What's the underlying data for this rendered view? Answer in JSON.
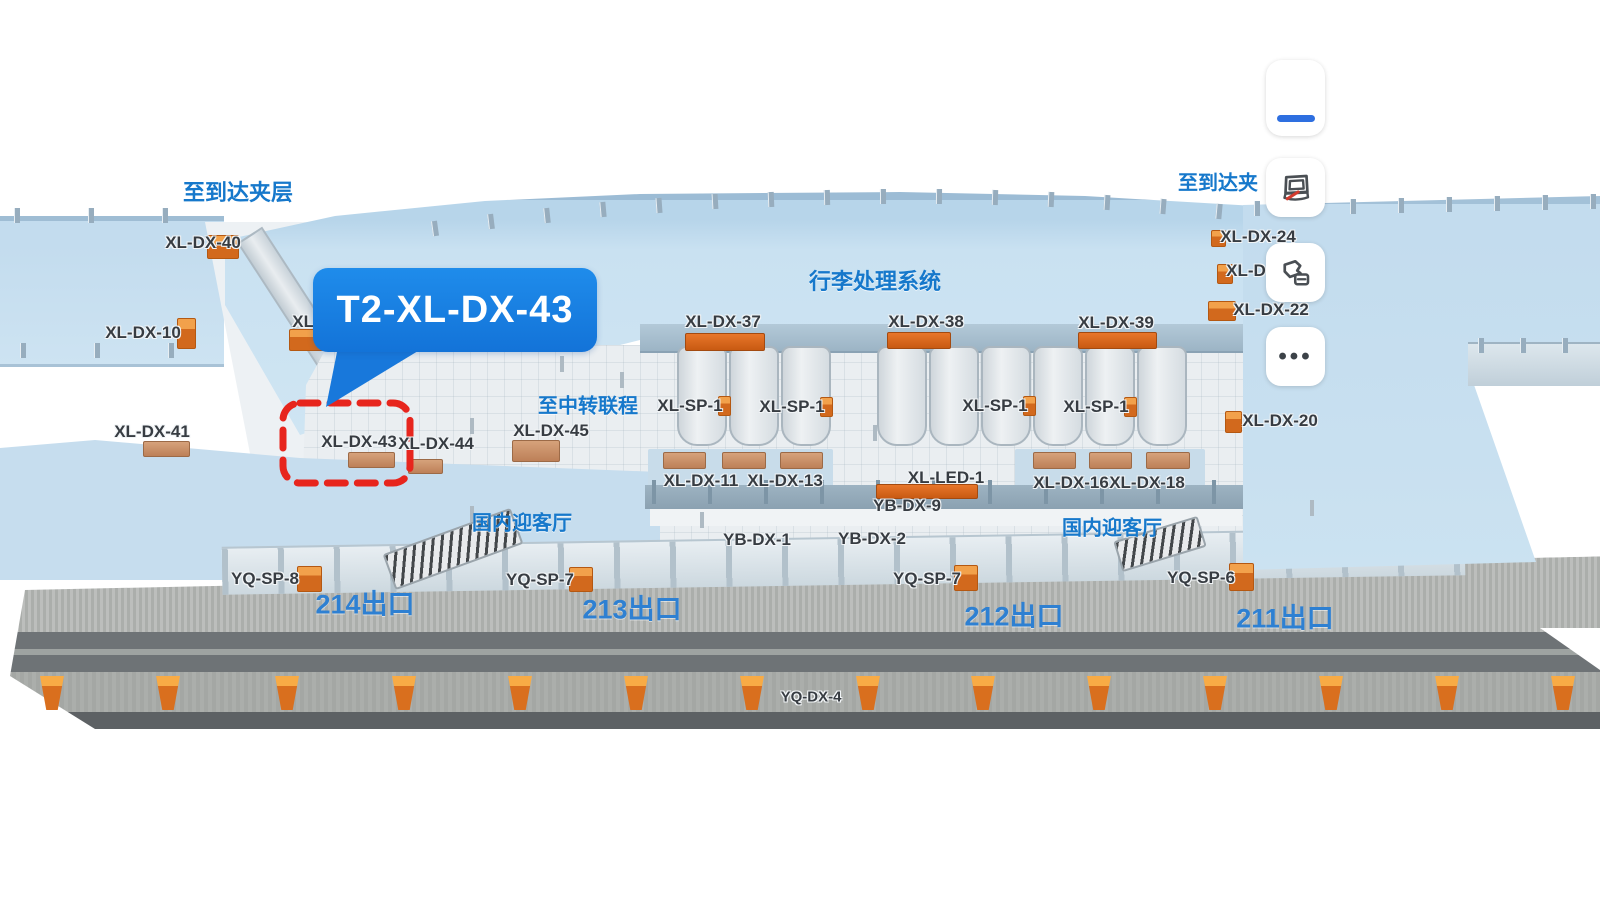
{
  "callout": {
    "label": "T2-XL-DX-43"
  },
  "zones": [
    {
      "text": "至到达夹层",
      "x": 238,
      "y": 191,
      "fs": 22
    },
    {
      "text": "行李处理系统",
      "x": 875,
      "y": 280,
      "fs": 22
    },
    {
      "text": "至中转联程",
      "x": 588,
      "y": 404,
      "fs": 20
    },
    {
      "text": "国内迎客厅",
      "x": 522,
      "y": 521,
      "fs": 20
    },
    {
      "text": "国内迎客厅",
      "x": 1112,
      "y": 526,
      "fs": 20
    },
    {
      "text": "至到达夹",
      "x": 1218,
      "y": 181,
      "fs": 20
    }
  ],
  "exits": [
    {
      "text": "214出口",
      "x": 365,
      "y": 602
    },
    {
      "text": "213出口",
      "x": 632,
      "y": 607
    },
    {
      "text": "212出口",
      "x": 1014,
      "y": 614
    },
    {
      "text": "211出口",
      "x": 1285,
      "y": 616
    }
  ],
  "devices": [
    {
      "text": "XL-DX-40",
      "x": 203,
      "y": 243
    },
    {
      "text": "XL-DX-10",
      "x": 143,
      "y": 333
    },
    {
      "text": "XL-DX-41",
      "x": 152,
      "y": 432
    },
    {
      "text": "XL-",
      "x": 306,
      "y": 322
    },
    {
      "text": "XL-DX-43",
      "x": 359,
      "y": 442
    },
    {
      "text": "XL-DX-44",
      "x": 436,
      "y": 444
    },
    {
      "text": "XL-DX-45",
      "x": 551,
      "y": 431
    },
    {
      "text": "XL-DX-37",
      "x": 723,
      "y": 322
    },
    {
      "text": "XL-DX-38",
      "x": 926,
      "y": 322
    },
    {
      "text": "XL-DX-39",
      "x": 1116,
      "y": 323
    },
    {
      "text": "XL-SP-1",
      "x": 690,
      "y": 406
    },
    {
      "text": "XL-SP-1",
      "x": 792,
      "y": 407
    },
    {
      "text": "XL-SP-1",
      "x": 995,
      "y": 406
    },
    {
      "text": "XL-SP-1",
      "x": 1096,
      "y": 407
    },
    {
      "text": "XL-DX-11",
      "x": 701,
      "y": 481
    },
    {
      "text": "XL-DX-13",
      "x": 785,
      "y": 481
    },
    {
      "text": "XL-LED-1",
      "x": 946,
      "y": 478
    },
    {
      "text": "YB-DX-9",
      "x": 907,
      "y": 506
    },
    {
      "text": "XL-DX-16",
      "x": 1071,
      "y": 483
    },
    {
      "text": "XL-DX-18",
      "x": 1147,
      "y": 483
    },
    {
      "text": "YB-DX-1",
      "x": 757,
      "y": 540
    },
    {
      "text": "YB-DX-2",
      "x": 872,
      "y": 539
    },
    {
      "text": "YQ-SP-8",
      "x": 265,
      "y": 579
    },
    {
      "text": "YQ-SP-7",
      "x": 540,
      "y": 580
    },
    {
      "text": "YQ-SP-7",
      "x": 927,
      "y": 579
    },
    {
      "text": "YQ-SP-6",
      "x": 1201,
      "y": 578
    },
    {
      "text": "YQ-DX-4",
      "x": 811,
      "y": 697,
      "fs": 15
    },
    {
      "text": "XL-DX-24",
      "x": 1258,
      "y": 237
    },
    {
      "text": "XL-D",
      "x": 1246,
      "y": 271
    },
    {
      "text": "XL-DX-22",
      "x": 1271,
      "y": 310
    },
    {
      "text": "XL-DX-20",
      "x": 1280,
      "y": 421
    }
  ],
  "markers": {
    "bars": [
      {
        "x": 685,
        "y": 333,
        "w": 78,
        "h": 16,
        "t": "orange"
      },
      {
        "x": 887,
        "y": 332,
        "w": 62,
        "h": 15,
        "t": "orange"
      },
      {
        "x": 1078,
        "y": 332,
        "w": 77,
        "h": 15,
        "t": "orange"
      },
      {
        "x": 876,
        "y": 484,
        "w": 100,
        "h": 13,
        "t": "orange"
      },
      {
        "x": 143,
        "y": 441,
        "w": 45,
        "h": 14,
        "t": "tan"
      },
      {
        "x": 348,
        "y": 452,
        "w": 45,
        "h": 14,
        "t": "tan"
      },
      {
        "x": 408,
        "y": 459,
        "w": 33,
        "h": 13,
        "t": "tan"
      },
      {
        "x": 512,
        "y": 440,
        "w": 46,
        "h": 20,
        "t": "tan"
      },
      {
        "x": 663,
        "y": 452,
        "w": 41,
        "h": 15,
        "t": "tan"
      },
      {
        "x": 722,
        "y": 452,
        "w": 42,
        "h": 15,
        "t": "tan"
      },
      {
        "x": 780,
        "y": 452,
        "w": 41,
        "h": 15,
        "t": "tan"
      },
      {
        "x": 1033,
        "y": 452,
        "w": 41,
        "h": 15,
        "t": "tan"
      },
      {
        "x": 1089,
        "y": 452,
        "w": 41,
        "h": 15,
        "t": "tan"
      },
      {
        "x": 1146,
        "y": 452,
        "w": 42,
        "h": 15,
        "t": "tan"
      }
    ],
    "cubes": [
      {
        "x": 207,
        "y": 235,
        "w": 30,
        "h": 22
      },
      {
        "x": 177,
        "y": 318,
        "w": 17,
        "h": 29
      },
      {
        "x": 289,
        "y": 329,
        "w": 34,
        "h": 20
      },
      {
        "x": 718,
        "y": 396,
        "w": 11,
        "h": 18
      },
      {
        "x": 820,
        "y": 397,
        "w": 11,
        "h": 18
      },
      {
        "x": 1023,
        "y": 396,
        "w": 11,
        "h": 18
      },
      {
        "x": 1124,
        "y": 397,
        "w": 11,
        "h": 18
      },
      {
        "x": 1211,
        "y": 230,
        "w": 13,
        "h": 15
      },
      {
        "x": 1217,
        "y": 264,
        "w": 14,
        "h": 18
      },
      {
        "x": 1208,
        "y": 301,
        "w": 26,
        "h": 18
      },
      {
        "x": 1225,
        "y": 411,
        "w": 15,
        "h": 20
      },
      {
        "x": 297,
        "y": 566,
        "w": 23,
        "h": 24
      },
      {
        "x": 569,
        "y": 567,
        "w": 22,
        "h": 23
      },
      {
        "x": 954,
        "y": 565,
        "w": 22,
        "h": 24
      },
      {
        "x": 1229,
        "y": 563,
        "w": 23,
        "h": 26
      }
    ],
    "bollards": {
      "xs": [
        52,
        168,
        287,
        404,
        520,
        636,
        752,
        868,
        983,
        1099,
        1215,
        1331,
        1447,
        1563
      ],
      "y": 676
    }
  },
  "toolbar": {
    "more_glyph": "•••",
    "buttons": [
      {
        "icon": "blue-dash-icon"
      },
      {
        "icon": "screen-frame-slash-icon"
      },
      {
        "icon": "floor-switch-icon"
      },
      {
        "icon": "ellipsis-icon"
      }
    ]
  },
  "colors": {
    "accent_blue": "#1678cb",
    "callout_blue": "#1b86e6",
    "highlight_red": "#e7251d",
    "marker_orange": "#d2691d",
    "terminal_blue": "#c9e1f1"
  }
}
